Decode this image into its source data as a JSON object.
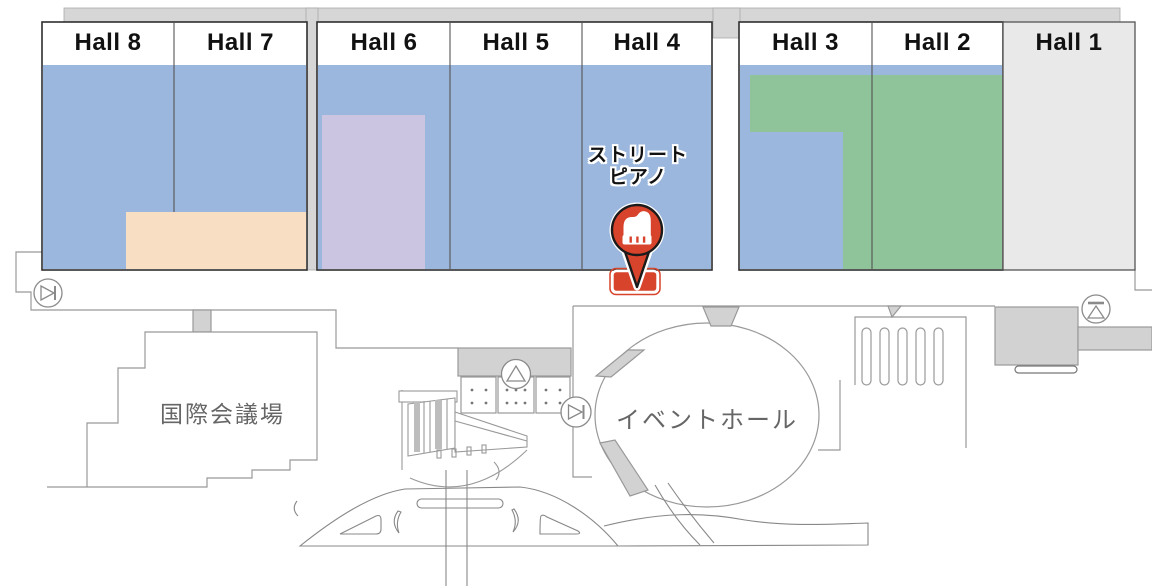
{
  "map": {
    "halls": [
      {
        "id": "hall-8",
        "label": "Hall 8"
      },
      {
        "id": "hall-7",
        "label": "Hall 7"
      },
      {
        "id": "hall-6",
        "label": "Hall 6"
      },
      {
        "id": "hall-5",
        "label": "Hall 5"
      },
      {
        "id": "hall-4",
        "label": "Hall 4"
      },
      {
        "id": "hall-3",
        "label": "Hall 3"
      },
      {
        "id": "hall-2",
        "label": "Hall 2"
      },
      {
        "id": "hall-1",
        "label": "Hall 1"
      }
    ],
    "marker": {
      "name": "street-piano",
      "label_lines": [
        "ストリート",
        "ピアノ"
      ],
      "icon": "grand-piano-icon"
    },
    "buildings": [
      {
        "id": "conference-center",
        "label": "国際会議場"
      },
      {
        "id": "event-hall",
        "label": "イベントホール"
      }
    ],
    "icons": [
      {
        "name": "gate-icon",
        "glyph": "circled right-triangle with bar"
      },
      {
        "name": "triangle-up-icon",
        "glyph": "circled upward triangle"
      },
      {
        "name": "escalator-icon",
        "glyph": "circled triangle under bar"
      },
      {
        "name": "grand-piano-icon",
        "glyph": "white grand piano silhouette"
      }
    ]
  },
  "colors": {
    "hall-blue": "#9bb7dd",
    "zone-peach": "#f8dfc4",
    "zone-purple": "#cbc5e2",
    "zone-green": "#8fc39a",
    "hall1-gray": "#e9e9e9",
    "walkway-gray": "#d6d6d6",
    "structure-gray": "#d2d2d2",
    "outline-gray": "#999999",
    "block-border": "#2e2e2e",
    "marker-red": "#d8432b",
    "hall-label-dark": "#111111",
    "building-label-gray": "#666666"
  }
}
